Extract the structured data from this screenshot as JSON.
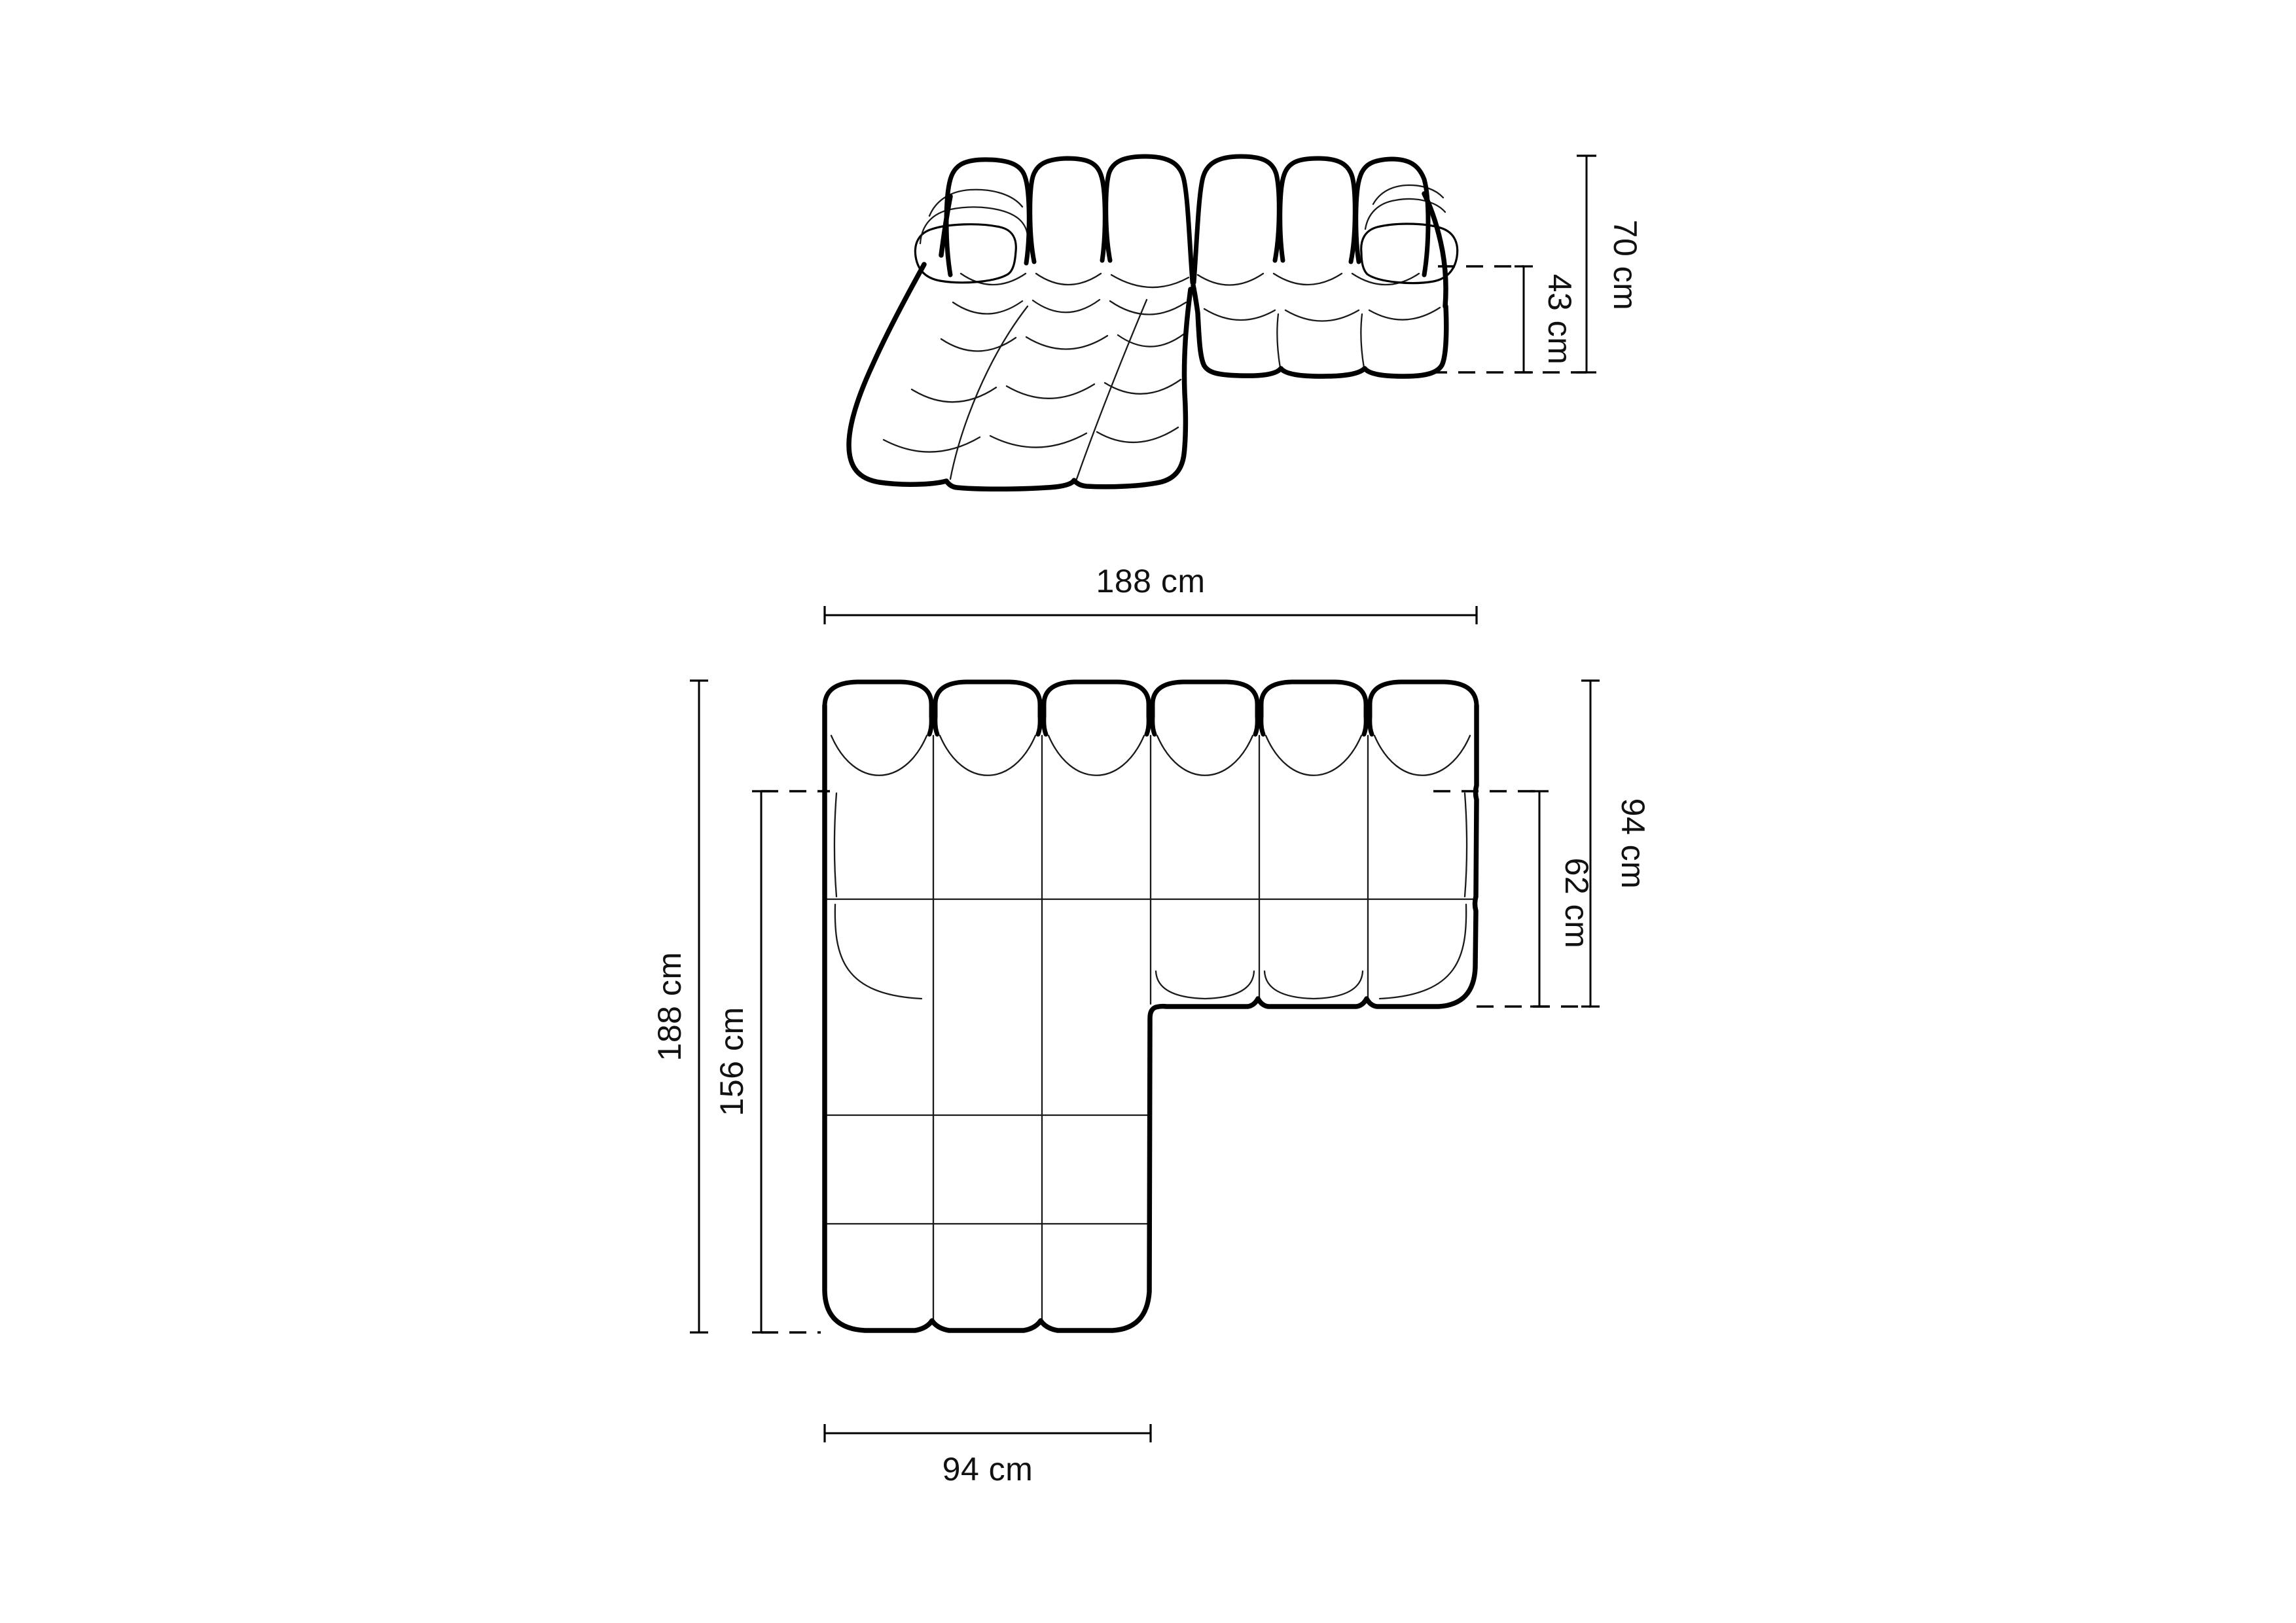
{
  "diagram": {
    "title": "sofa-dimension-drawing",
    "background_color": "#ffffff",
    "line_color": "#000000",
    "text_color": "#111111",
    "front_view": {
      "name": "modular chaise sofa - front perspective view",
      "dims": [
        {
          "id": "total-height",
          "label": "70 cm"
        },
        {
          "id": "seat-height",
          "label": "43 cm"
        }
      ]
    },
    "plan_view": {
      "name": "modular chaise sofa - top plan view",
      "dims": [
        {
          "id": "total-width",
          "label": "188 cm"
        },
        {
          "id": "total-depth",
          "label": "188 cm"
        },
        {
          "id": "chaise-length",
          "label": "156 cm"
        },
        {
          "id": "sofa-depth",
          "label": "94 cm"
        },
        {
          "id": "seat-depth",
          "label": "62 cm"
        },
        {
          "id": "chaise-width",
          "label": "94 cm"
        }
      ]
    }
  }
}
